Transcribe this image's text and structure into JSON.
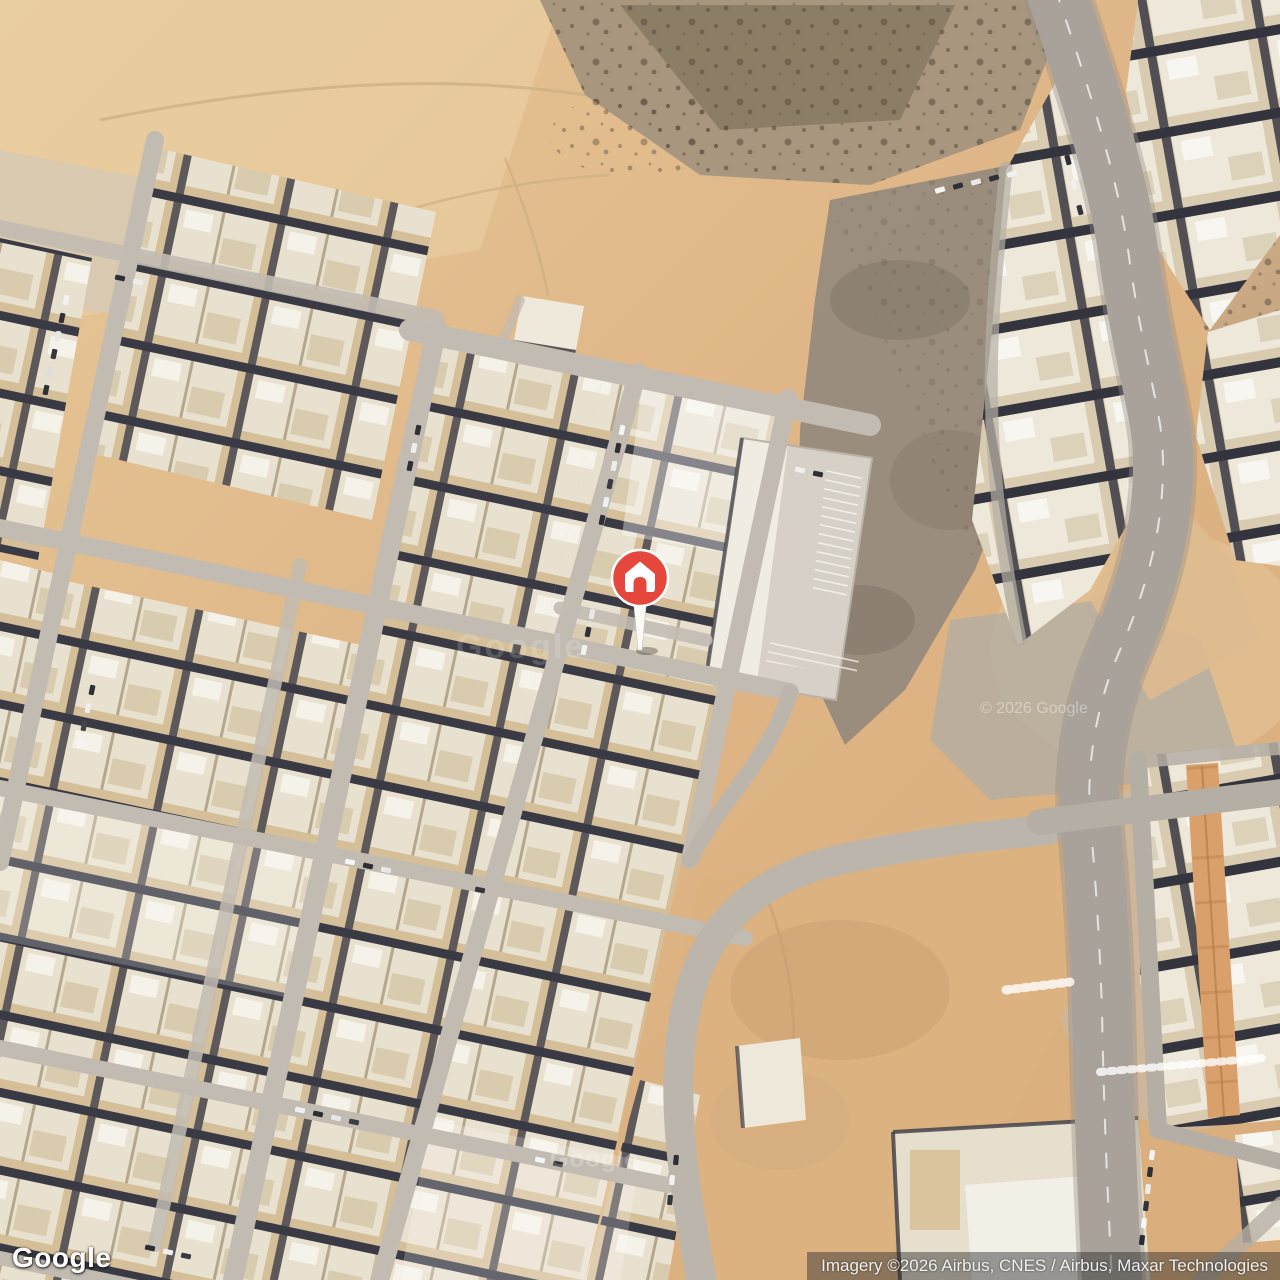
{
  "page": {
    "title": "Google Maps satellite view with place marker"
  },
  "map": {
    "view_type": "satellite",
    "marker": {
      "type": "home-place-marker",
      "color": "#E5473C"
    },
    "watermarks": {
      "center": "Google",
      "tile": "Google",
      "copyright": "© 2026 Google"
    }
  },
  "footer": {
    "logo_text": "Google",
    "attribution_text": "Imagery ©2026 Airbus, CNES / Airbus, Maxar Technologies"
  }
}
